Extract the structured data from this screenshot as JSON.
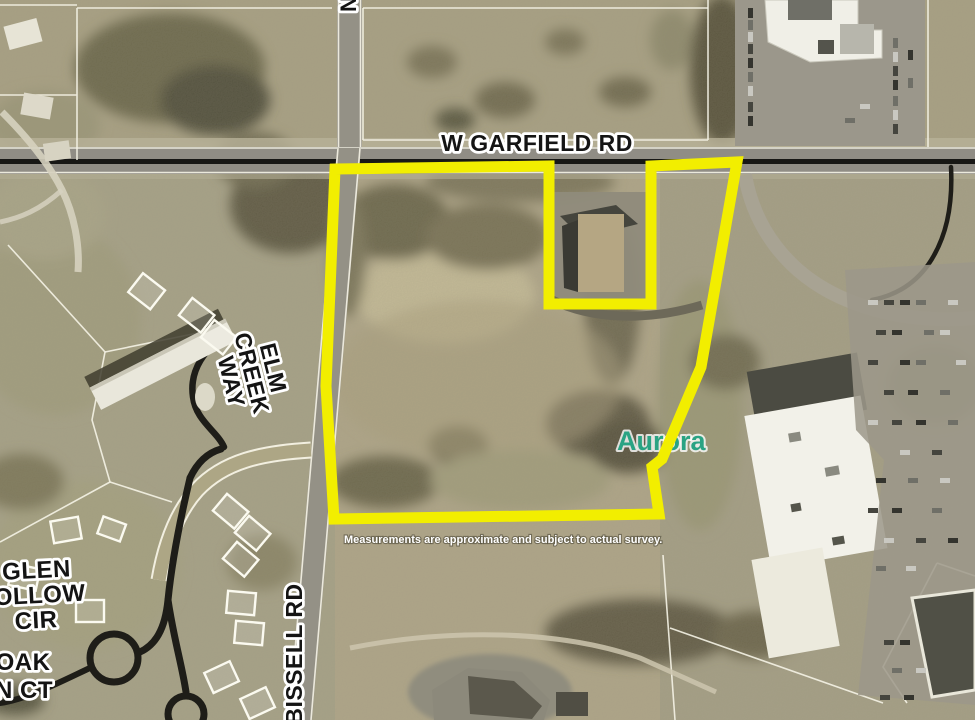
{
  "map": {
    "road_labels": {
      "garfield": "W GARFIELD RD",
      "north_partial": "N",
      "elm_creek_lines": [
        "ELM",
        "CREEK",
        "WAY"
      ],
      "glen_hollow_lines": [
        "GLEN",
        "HOLLOW",
        "CIR"
      ],
      "oak_ct_lines": [
        "OAK",
        "N CT"
      ],
      "bissell": "BISSELL RD"
    },
    "place_labels": {
      "city": "Aurora"
    },
    "disclaimer": "Measurements are approximate and subject to actual survey.",
    "colors": {
      "boundary_yellow": "#F2EE00",
      "city_teal": "#2AA383",
      "label_black": "#141414",
      "label_halo": "#FFFFFF"
    }
  }
}
